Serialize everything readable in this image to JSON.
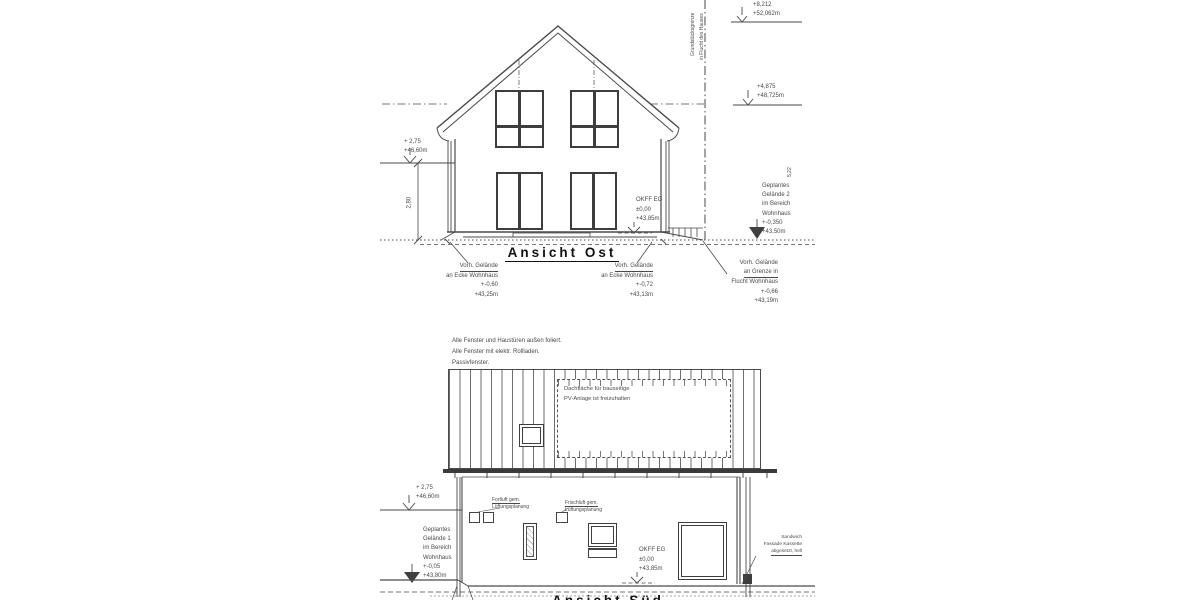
{
  "ansicht_ost": {
    "title": "Ansicht Ost",
    "marker_ridge": {
      "rel": "+8,212",
      "abs": "+52,062m"
    },
    "marker_upper": {
      "rel": "+4,875",
      "abs": "+48,725m"
    },
    "marker_eave": {
      "rel": "+ 2,75",
      "abs": "+46,60m"
    },
    "dim_wall_height": "2,80",
    "dim_right": "5,22",
    "okff": {
      "l1": "OKFF EG",
      "l2": "±0,00",
      "l3": "+43,85m"
    },
    "gelaende2": [
      "Geplantes",
      "Gelände 2",
      "im Bereich",
      "Wohnhaus",
      "+-0,350",
      "+43,50m"
    ],
    "boundary": [
      "Grundstücksgrenze",
      "in Flucht des Hauses"
    ],
    "note_left": [
      "Vorh. Gelände",
      "an Ecke Wohnhaus",
      "+-0,60",
      "+43,25m"
    ],
    "note_mid": [
      "Vorh. Gelände",
      "an Ecke Wohnhaus",
      "+-0,72",
      "+43,13m"
    ],
    "note_right": [
      "Vorh. Gelände",
      "an Grenze in",
      "Flucht Wohnhaus",
      "+-0,66",
      "+43,19m"
    ]
  },
  "ansicht_sued": {
    "title": "Ansicht Süd",
    "general_notes": [
      "Alle Fenster und Haustüren außen foliert.",
      "Alle Fenster mit elektr. Rollladen.",
      "Passivfenster."
    ],
    "pv_note": [
      "Dachfläche für bauseitige",
      "PV-Anlage ist freizuhalten"
    ],
    "vent_exhaust": [
      "Fortluft gem.",
      "Lüftungsplanung"
    ],
    "vent_fresh": [
      "Frischluft gem.",
      "Lüftungsplanung"
    ],
    "marker_eave": {
      "rel": "+ 2,75",
      "abs": "+46,60m"
    },
    "gelaende1": [
      "Geplantes",
      "Gelände 1",
      "im Bereich",
      "Wohnhaus",
      "+-0,05",
      "+43,80m"
    ],
    "okff": {
      "l1": "OKFF EG",
      "l2": "±0,00",
      "l3": "+43,85m"
    },
    "facade_note": [
      "Sandwich",
      "Fassade Kassette",
      "abgesetzt, hell"
    ]
  }
}
